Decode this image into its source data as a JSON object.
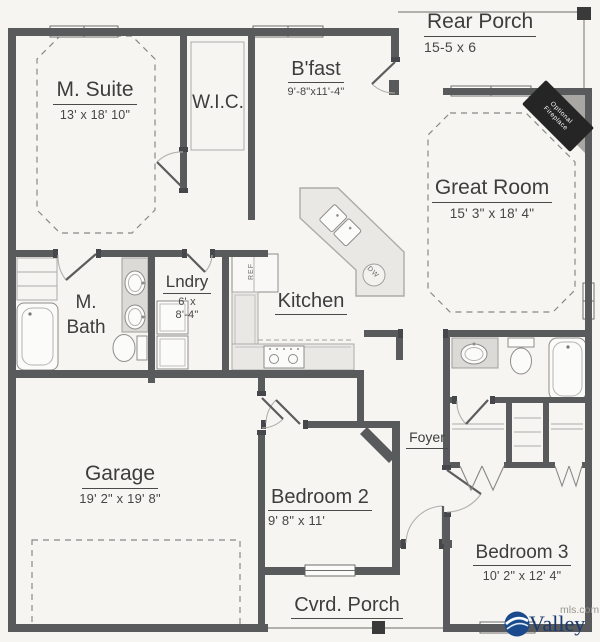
{
  "plan": {
    "rooms": {
      "m_suite": {
        "name": "M. Suite",
        "dims": "13' x 18' 10\""
      },
      "wic": {
        "name": "W.I.C."
      },
      "bfast": {
        "name": "B'fast",
        "dims": "9'-8\"x11'-4\""
      },
      "rear_porch": {
        "name": "Rear Porch",
        "dims": "15-5 x 6"
      },
      "great_room": {
        "name": "Great Room",
        "dims": "15' 3\" x 18' 4\""
      },
      "m_bath": {
        "name_line1": "M.",
        "name_line2": "Bath"
      },
      "lndry": {
        "name": "Lndry",
        "dims1": "6' x",
        "dims2": "8'-4\""
      },
      "kitchen": {
        "name": "Kitchen"
      },
      "foyer": {
        "name": "Foyer"
      },
      "garage": {
        "name": "Garage",
        "dims": "19' 2\" x 19' 8\""
      },
      "bedroom2": {
        "name": "Bedroom 2",
        "dims": "9' 8\" x 11'"
      },
      "bedroom3": {
        "name": "Bedroom 3",
        "dims": "10' 2\" x 12' 4\""
      },
      "cvrd_porch": {
        "name": "Cvrd. Porch"
      }
    },
    "annotations": {
      "fireplace_line1": "Optional",
      "fireplace_line2": "Fireplace",
      "ref": "REF",
      "dw": "DW"
    },
    "watermark": {
      "brand": "Valley",
      "suffix": "mls.com"
    },
    "colors": {
      "wall": "#595a5c",
      "fireplace_tag": "#252525",
      "brand_navy": "#1b3a6e",
      "logo_blue": "#1a4a8c"
    }
  }
}
